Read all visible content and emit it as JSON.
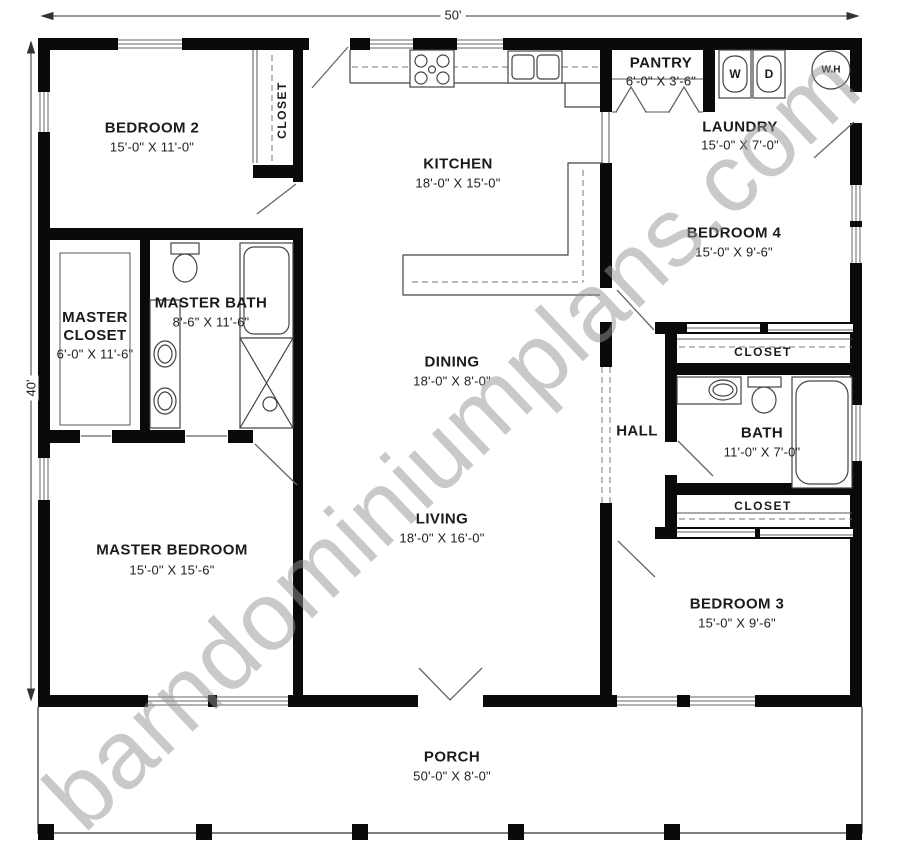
{
  "plan_title": "Barndominium Floor Plan",
  "watermark": "barndominiumplans.com",
  "dimensions": {
    "overall_width": "50'",
    "overall_height": "40'"
  },
  "labels": {
    "closet": "CLOSET",
    "washer": "W",
    "dryer": "D",
    "water_heater": "W.H"
  },
  "rooms": [
    {
      "id": "bedroom-2",
      "name": "BEDROOM 2",
      "dims": "15'-0\" X 11'-0\""
    },
    {
      "id": "kitchen",
      "name": "KITCHEN",
      "dims": "18'-0\" X 15'-0\""
    },
    {
      "id": "pantry",
      "name": "PANTRY",
      "dims": "6'-0\" X 3'-6\""
    },
    {
      "id": "laundry",
      "name": "LAUNDRY",
      "dims": "15'-0\" X 7'-0\""
    },
    {
      "id": "bedroom-4",
      "name": "BEDROOM 4",
      "dims": "15'-0\" X 9'-6\""
    },
    {
      "id": "master-closet",
      "name": "MASTER CLOSET",
      "dims": "6'-0\" X 11'-6\""
    },
    {
      "id": "master-bath",
      "name": "MASTER BATH",
      "dims": "8'-6\" X 11'-6\""
    },
    {
      "id": "dining",
      "name": "DINING",
      "dims": "18'-0\" X 8'-0\""
    },
    {
      "id": "hall",
      "name": "HALL",
      "dims": ""
    },
    {
      "id": "bath",
      "name": "BATH",
      "dims": "11'-0\" X 7'-0\""
    },
    {
      "id": "master-bedroom",
      "name": "MASTER BEDROOM",
      "dims": "15'-0\" X 15'-6\""
    },
    {
      "id": "living",
      "name": "LIVING",
      "dims": "18'-0\" X 16'-0\""
    },
    {
      "id": "bedroom-3",
      "name": "BEDROOM 3",
      "dims": "15'-0\" X 9'-6\""
    },
    {
      "id": "porch",
      "name": "PORCH",
      "dims": "50'-0\" X 8'-0\""
    }
  ]
}
